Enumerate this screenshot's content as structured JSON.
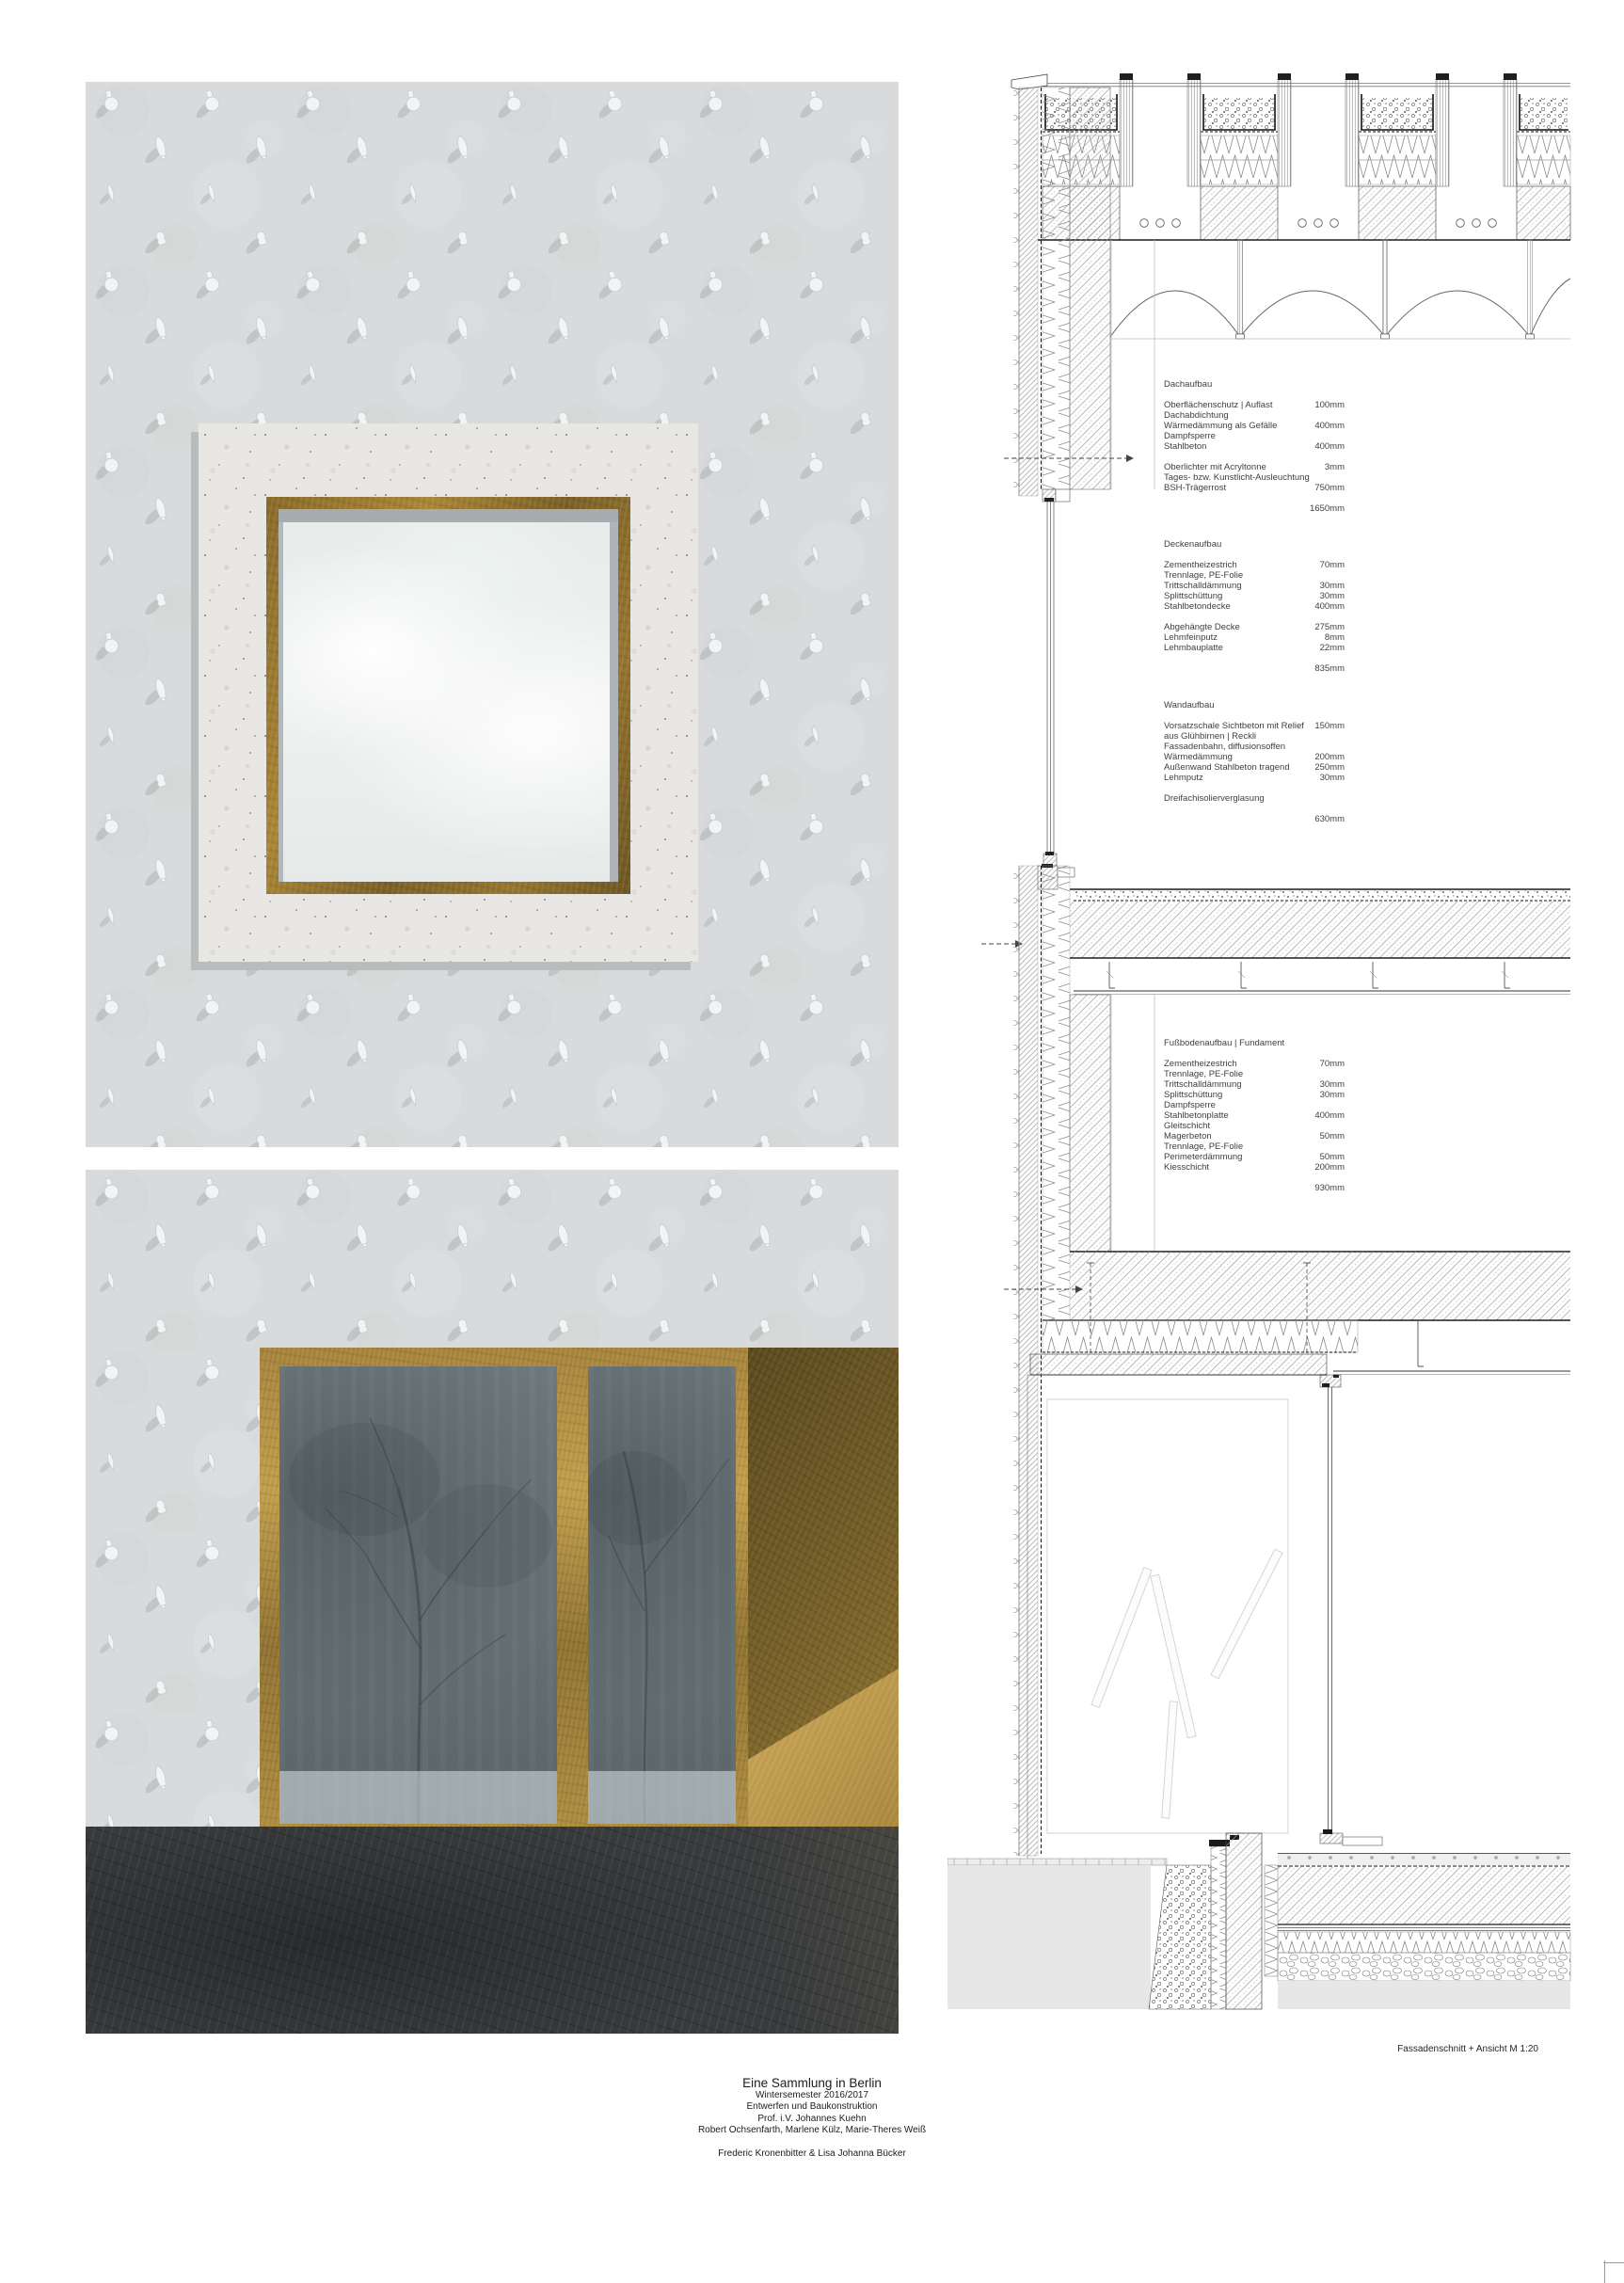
{
  "colors": {
    "gold": "#a5823a",
    "gold_dark": "#6f5a26",
    "concrete": "#d8dadb",
    "panel_concrete": "#e9e7e3",
    "glass_lower": "#6e797d",
    "glass_upper": "#eef1ef",
    "floor": "#3a3c3e",
    "drawing_line": "#3f3f3f"
  },
  "annotations": {
    "blocks": [
      {
        "heading": "Dachaufbau",
        "rows": [
          {
            "label": "Oberflächenschutz | Auflast",
            "value": "100mm"
          },
          {
            "label": "Dachabdichtung",
            "value": ""
          },
          {
            "label": "Wärmedämmung als Gefälle",
            "value": "400mm"
          },
          {
            "label": "Dampfsperre",
            "value": ""
          },
          {
            "label": "Stahlbeton",
            "value": "400mm"
          },
          {
            "gap": true,
            "label": "",
            "value": ""
          },
          {
            "label": "Oberlichter mit Acryltonne",
            "value": "3mm"
          },
          {
            "label": "Tages- bzw. Kunstlicht-Ausleuchtung",
            "value": ""
          },
          {
            "label": "BSH-Trägerrost",
            "value": "750mm"
          }
        ],
        "total": "1650mm"
      },
      {
        "heading": "Deckenaufbau",
        "rows": [
          {
            "label": "Zementheizestrich",
            "value": "70mm"
          },
          {
            "label": "Trennlage, PE-Folie",
            "value": ""
          },
          {
            "label": "Trittschalldämmung",
            "value": "30mm"
          },
          {
            "label": "Splittschüttung",
            "value": "30mm"
          },
          {
            "label": "Stahlbetondecke",
            "value": "400mm"
          },
          {
            "gap": true,
            "label": "",
            "value": ""
          },
          {
            "label": "Abgehängte Decke",
            "value": "275mm"
          },
          {
            "label": "Lehmfeinputz",
            "value": "8mm"
          },
          {
            "label": "Lehmbauplatte",
            "value": "22mm"
          }
        ],
        "total": "835mm"
      },
      {
        "heading": "Wandaufbau",
        "rows": [
          {
            "label": "Vorsatzschale Sichtbeton mit Relief",
            "value": "150mm"
          },
          {
            "label": "aus Glühbirnen | Reckli",
            "value": ""
          },
          {
            "label": "Fassadenbahn, diffusionsoffen",
            "value": ""
          },
          {
            "label": "Wärmedämmung",
            "value": "200mm"
          },
          {
            "label": "Außenwand Stahlbeton tragend",
            "value": "250mm"
          },
          {
            "label": "Lehmputz",
            "value": "30mm"
          },
          {
            "gap": true,
            "label": "",
            "value": ""
          },
          {
            "label": "Dreifachisolierverglasung",
            "value": ""
          }
        ],
        "total": "630mm"
      },
      {
        "heading": "Fußbodenaufbau | Fundament",
        "rows": [
          {
            "label": "Zementheizestrich",
            "value": "70mm"
          },
          {
            "label": "Trennlage, PE-Folie",
            "value": ""
          },
          {
            "label": "Trittschalldämmung",
            "value": "30mm"
          },
          {
            "label": "Splittschüttung",
            "value": "30mm"
          },
          {
            "label": "Dampfsperre",
            "value": ""
          },
          {
            "label": "Stahlbetonplatte",
            "value": "400mm"
          },
          {
            "label": "Gleitschicht",
            "value": ""
          },
          {
            "label": "Magerbeton",
            "value": "50mm"
          },
          {
            "label": "Trennlage, PE-Folie",
            "value": ""
          },
          {
            "label": "Perimeterdämmung",
            "value": "50mm"
          },
          {
            "label": "Kiesschicht",
            "value": "200mm"
          }
        ],
        "total": "930mm"
      }
    ]
  },
  "drawing_label": "Fassadenschnitt + Ansicht M 1:20",
  "title_block": {
    "title": "Eine Sammlung in Berlin",
    "lines": [
      {
        "text": "Wintersemester 2016/2017"
      },
      {
        "text": "Entwerfen und Baukonstruktion"
      },
      {
        "text": "Prof. i.V. Johannes Kuehn"
      },
      {
        "text": "Robert Ochsenfarth, Marlene Külz, Marie-Theres Weiß"
      }
    ],
    "authors": "Frederic Kronenbitter & Lisa Johanna Bücker"
  }
}
